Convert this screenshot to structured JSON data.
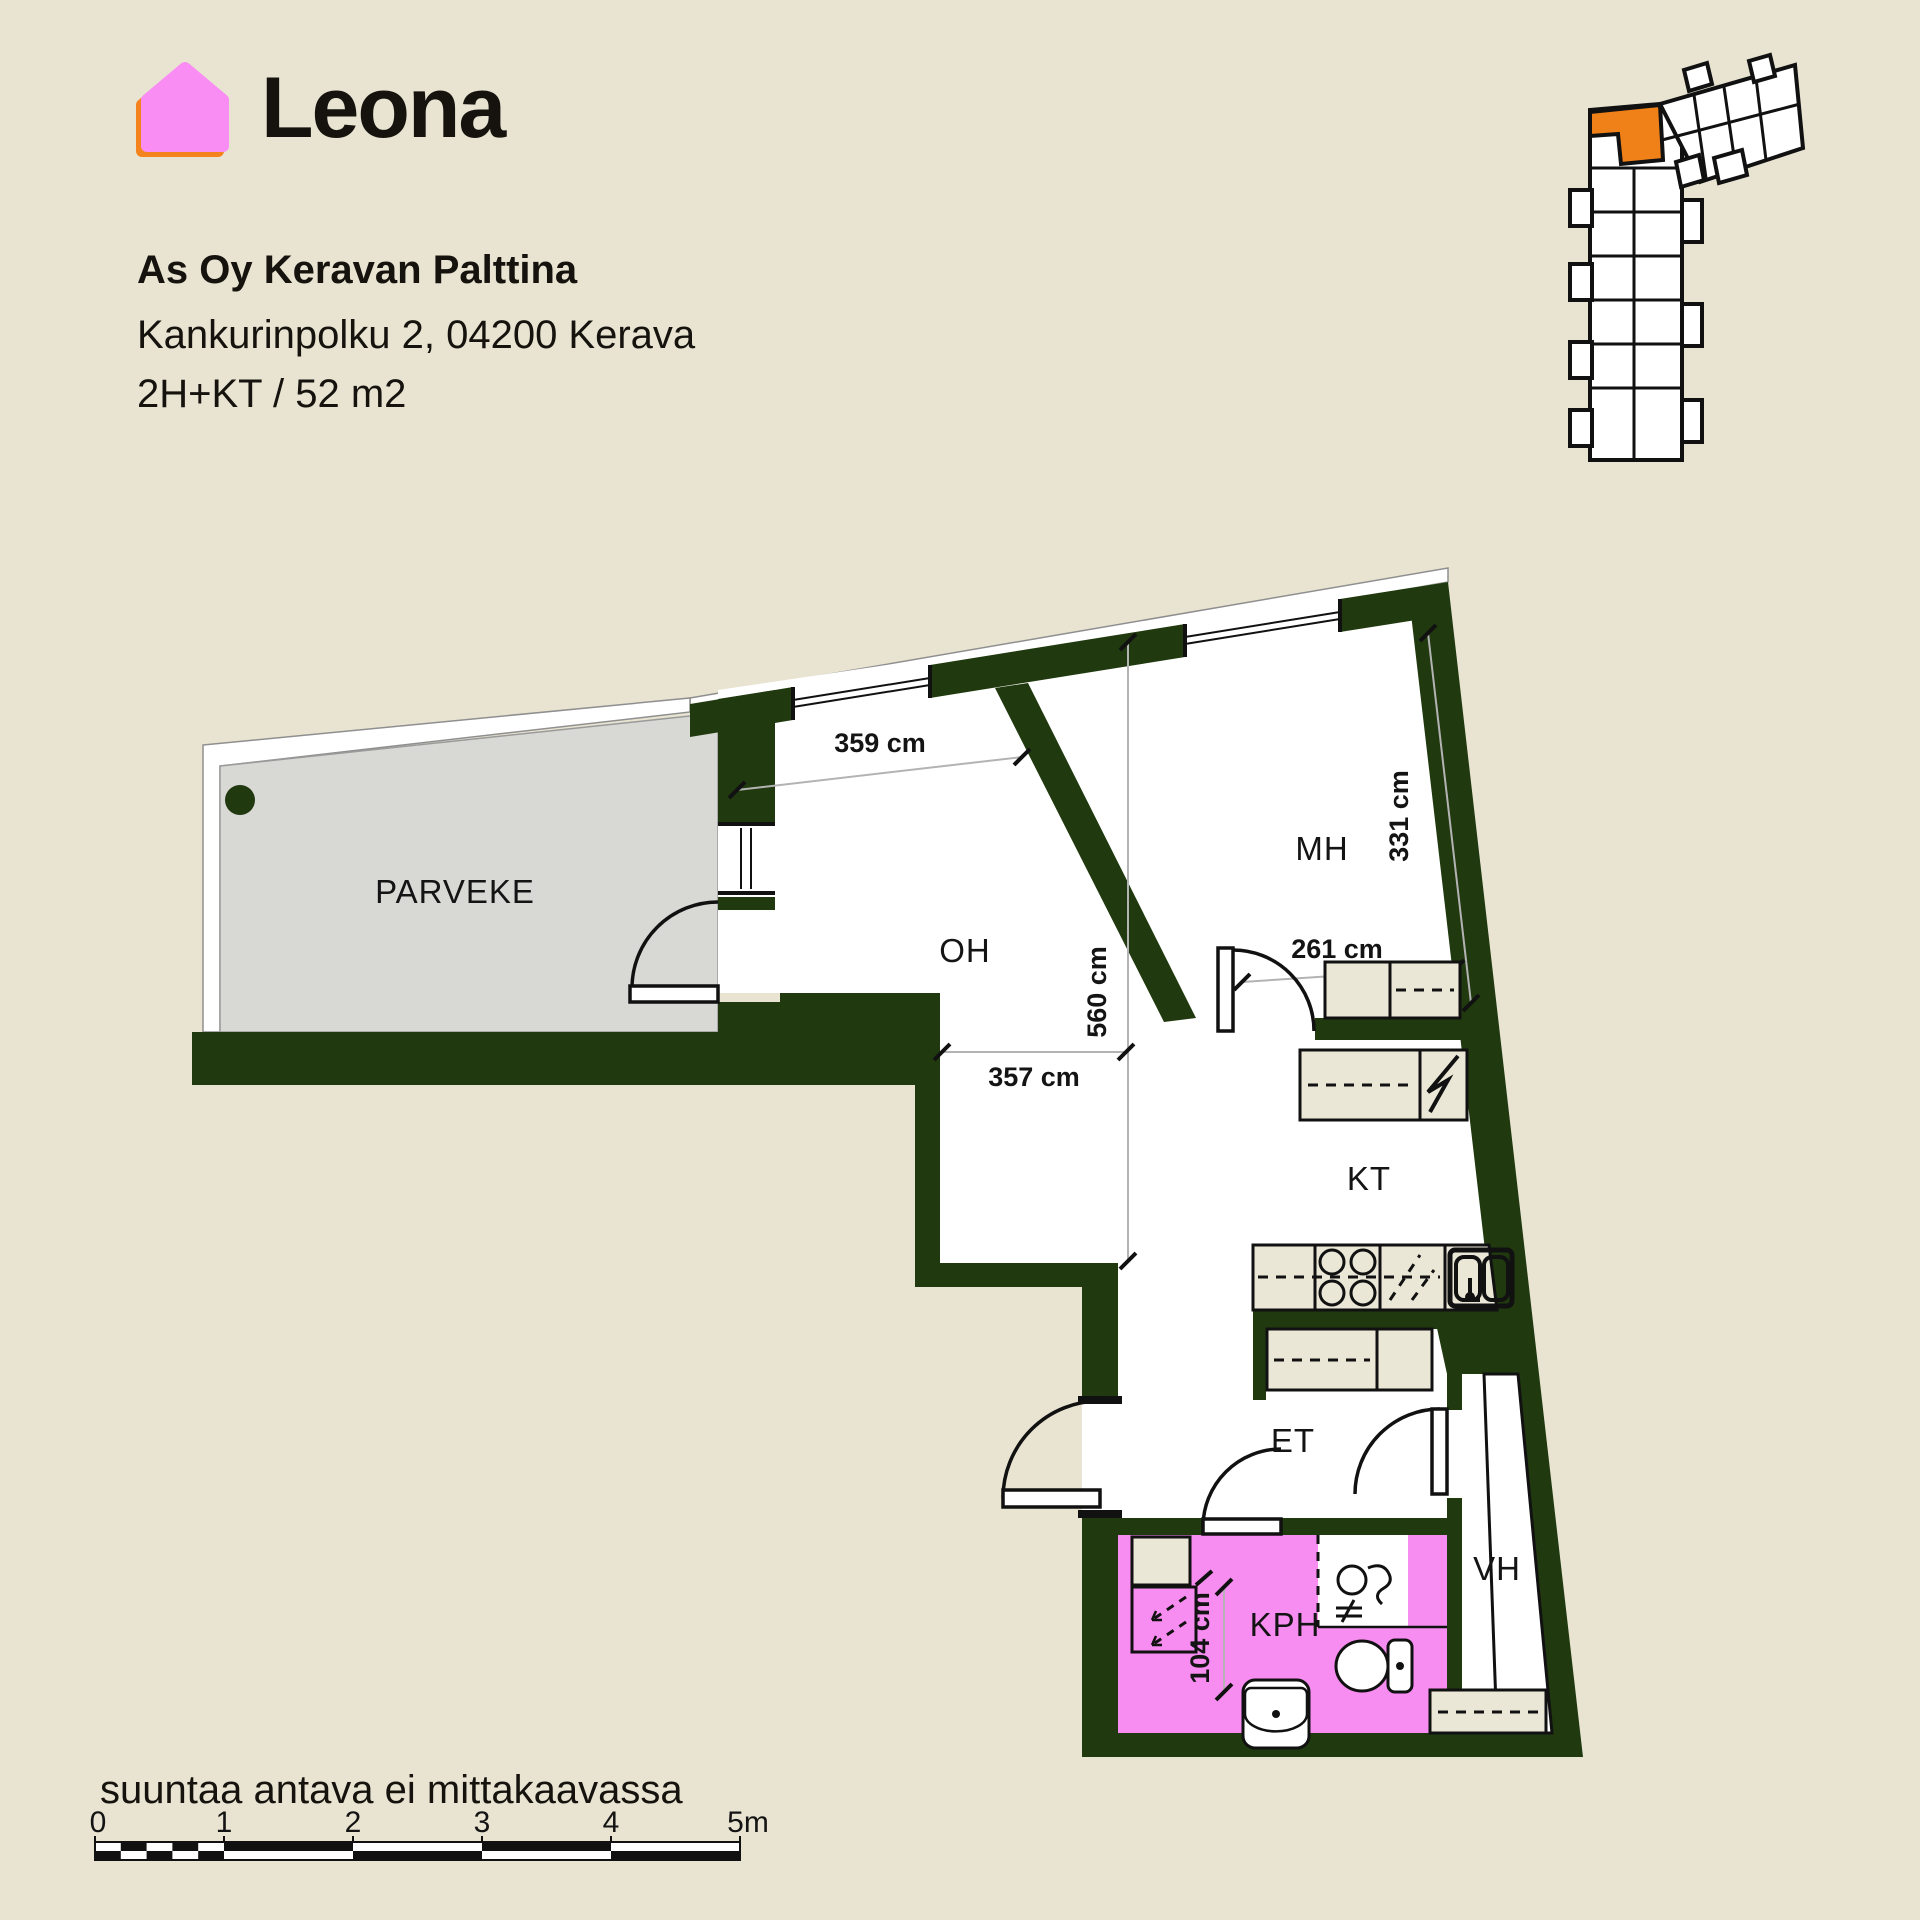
{
  "brand": {
    "name": "Leona"
  },
  "header": {
    "project": "As Oy Keravan Palttina",
    "address": "Kankurinpolku 2, 04200 Kerava",
    "unit_info": "2H+KT / 52 m2"
  },
  "rooms": {
    "parveke": "PARVEKE",
    "oh": "OH",
    "mh": "MH",
    "kt": "KT",
    "et": "ET",
    "kph": "KPH",
    "vh": "VH"
  },
  "dimensions": {
    "oh_width": "359 cm",
    "oh_height": "560 cm",
    "oh_lower_width": "357 cm",
    "mh_height": "331 cm",
    "mh_width": "261 cm",
    "kph_width": "104 cm"
  },
  "footer": {
    "disclaimer": "suuntaa antava ei mittakaavassa",
    "scale_labels": [
      "0",
      "1",
      "2",
      "3",
      "4",
      "5m"
    ]
  },
  "colors": {
    "background": "#e8e4d1",
    "wall_green": "#20390e",
    "balcony_gray": "#d8d8d5",
    "bathroom_pink": "#f78df0",
    "furniture_beige": "#eae7d6",
    "highlight_orange": "#f08118",
    "logo_pink": "#f98df3",
    "logo_orange": "#f5831d",
    "dimension_line_gray": "#b3b3b3",
    "text": "#141414"
  }
}
